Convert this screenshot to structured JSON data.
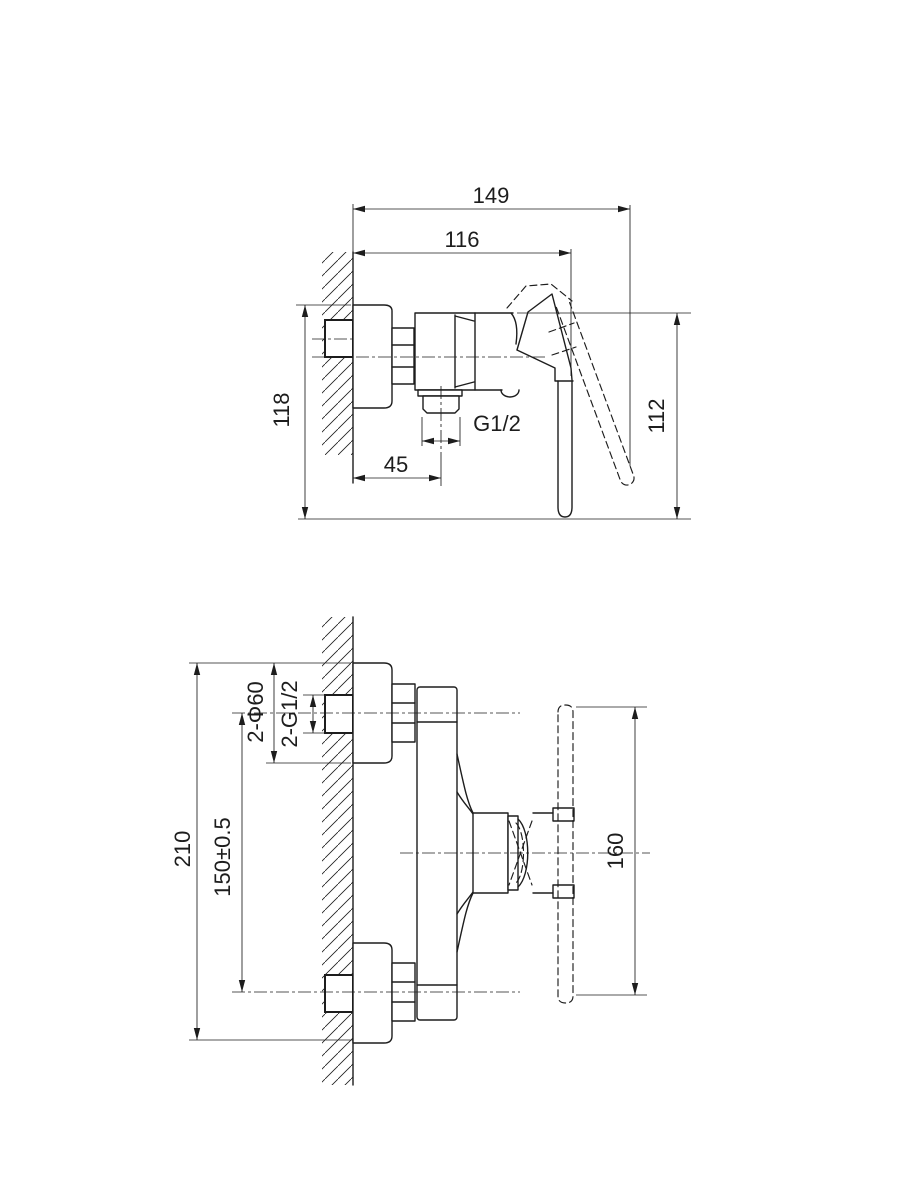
{
  "drawing": {
    "title": "shower mixer installation drawing",
    "background_color": "#ffffff",
    "line_color": "#1d1d1d",
    "side_view": {
      "label": "side view",
      "dim_total_depth": "149",
      "dim_body_depth": "116",
      "dim_height_wall_side": "118",
      "dim_height_handle_side": "112",
      "dim_outlet_offset": "45",
      "dim_outlet_thread": "G1/2"
    },
    "front_view": {
      "label": "front view",
      "dim_total_height": "210",
      "dim_inlet_spacing": "150±0.5",
      "dim_escutcheon_diameter": "2-Φ60",
      "dim_inlet_thread": "2-G1/2",
      "dim_handle_length": "160"
    }
  }
}
